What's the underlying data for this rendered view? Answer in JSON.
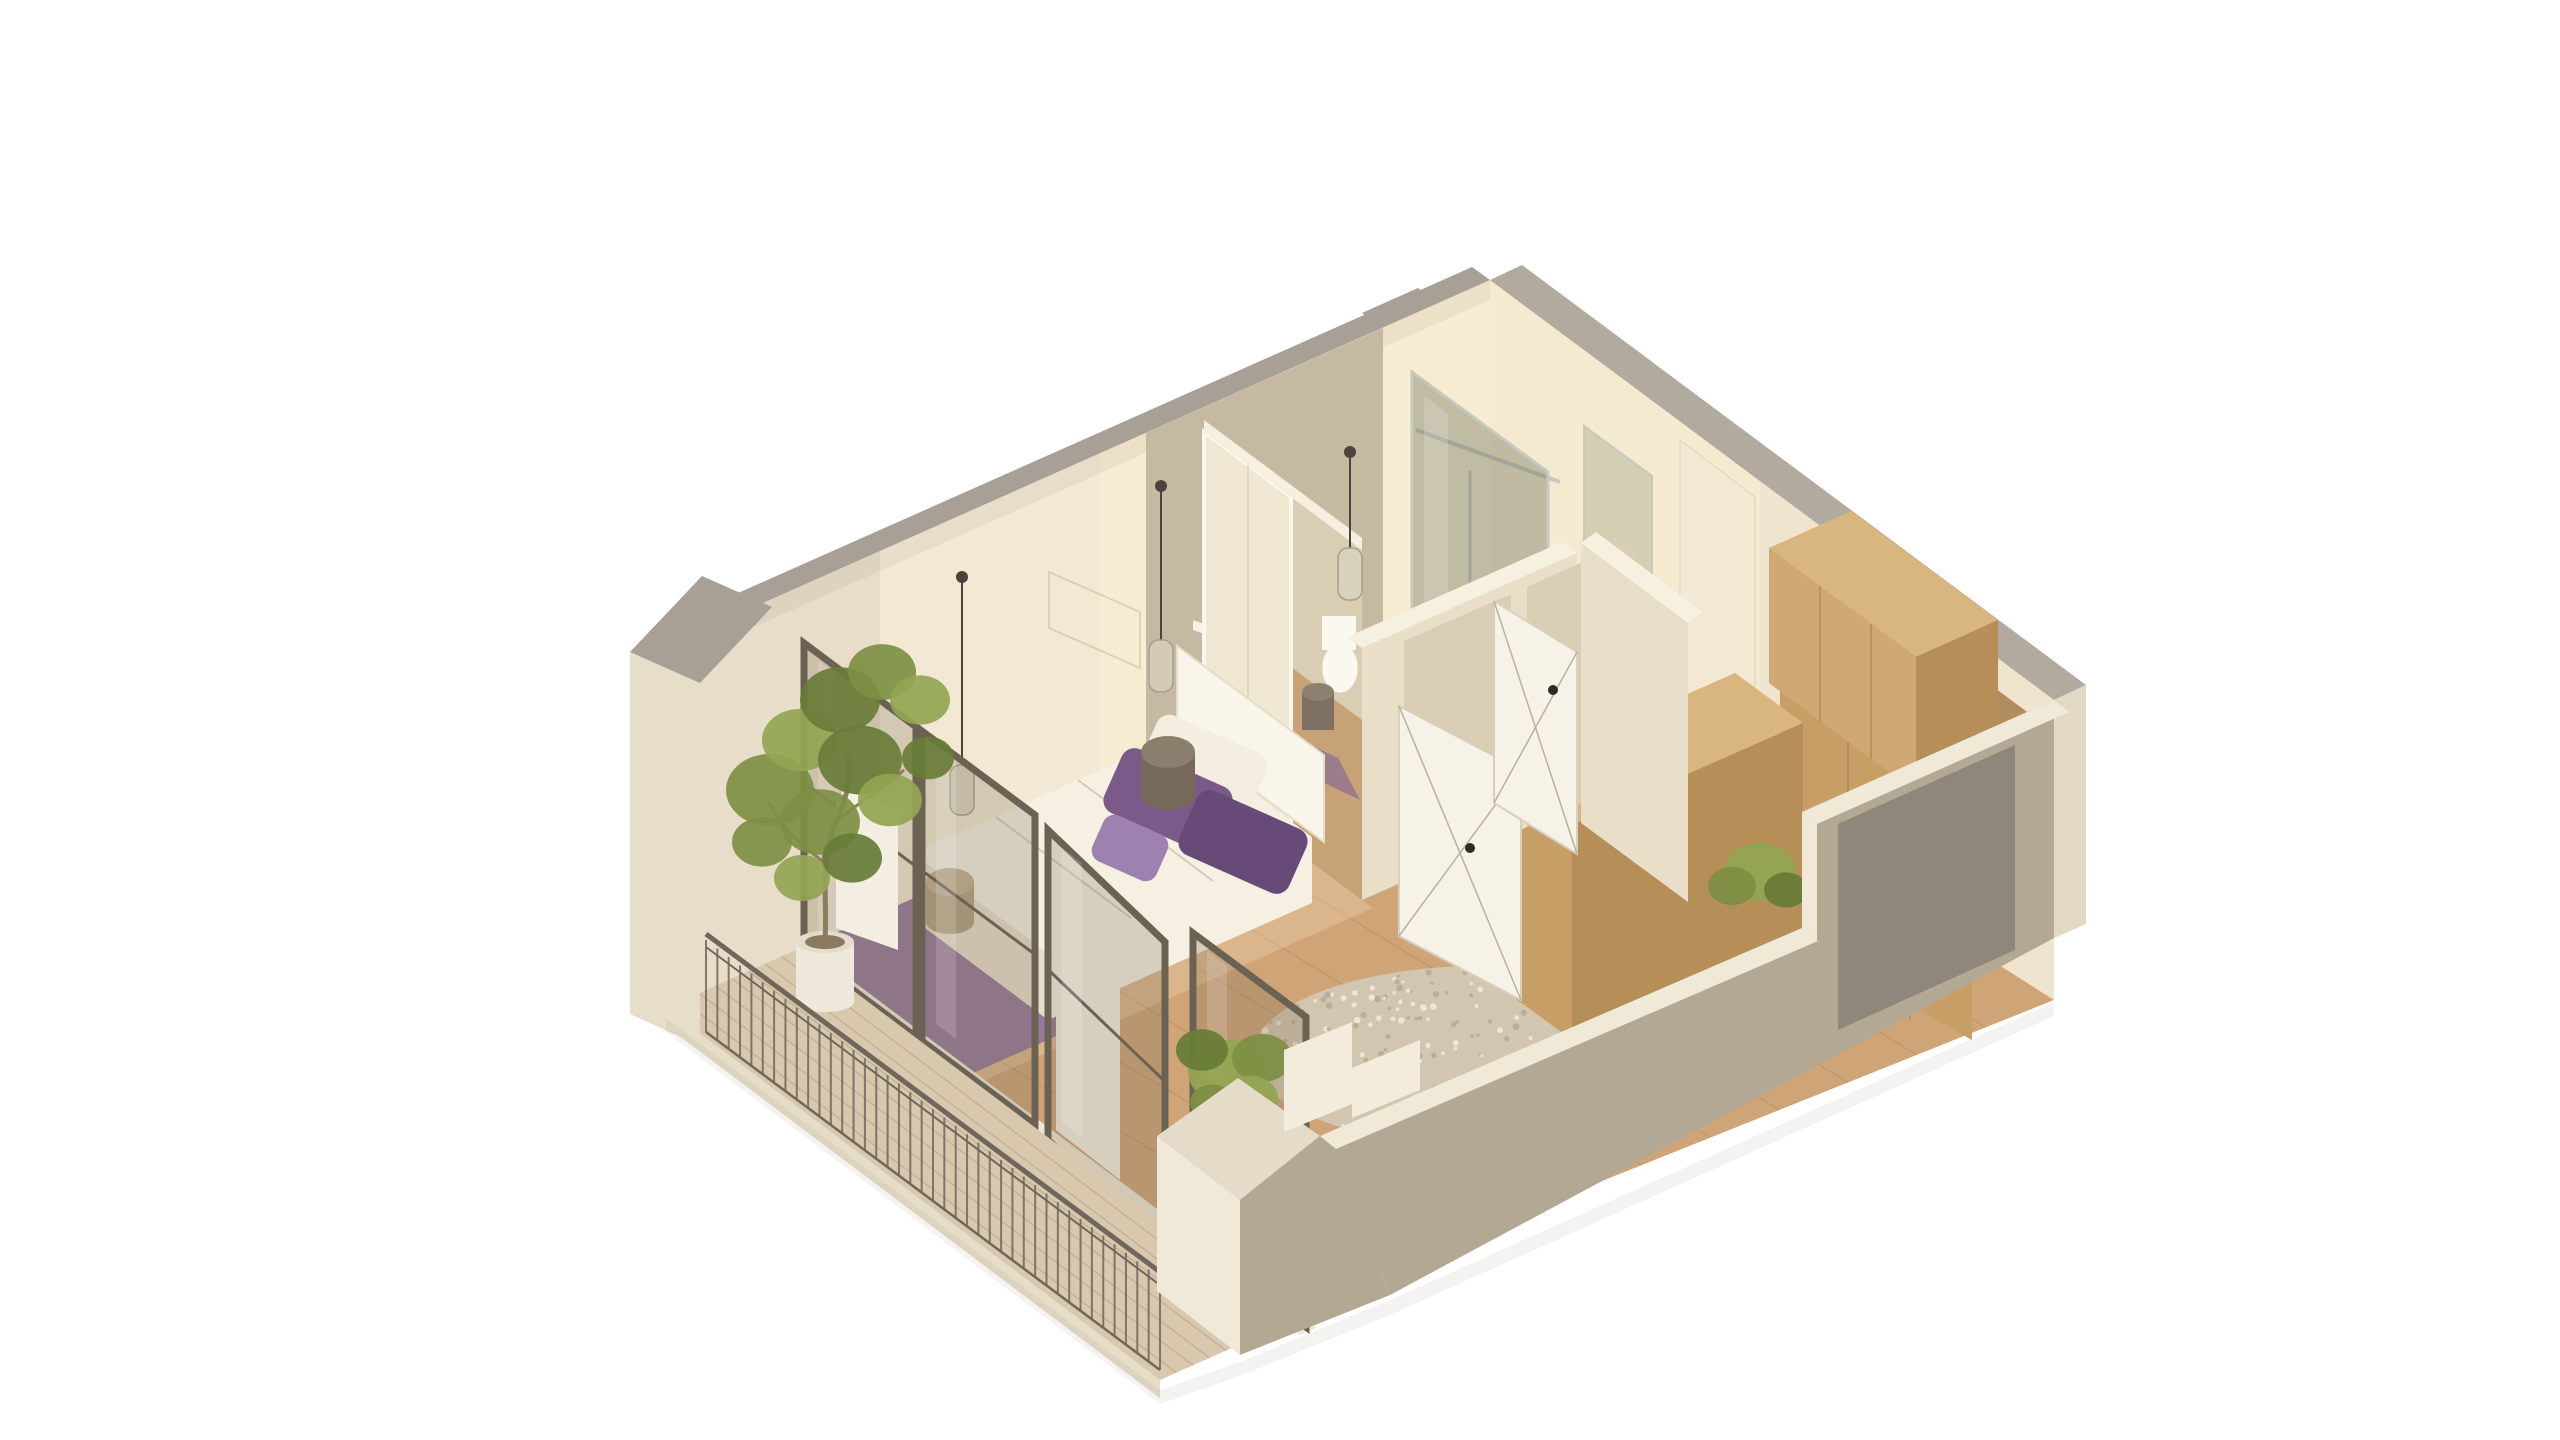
{
  "scene": {
    "type": "isometric-3d-apartment-floorplan-render",
    "background": "#ffffff",
    "rooms": [
      {
        "name": "bedroom"
      },
      {
        "name": "bathroom"
      },
      {
        "name": "living-hall"
      },
      {
        "name": "balcony"
      },
      {
        "name": "entry"
      }
    ],
    "objects": [
      "bed",
      "purple-pillows",
      "headboard",
      "wardrobe-sliding-doors",
      "walk-in-shower",
      "toilet",
      "interior-doors",
      "pendant-lamps",
      "glass-balcony-doors",
      "balcony-railing",
      "potted-tree",
      "planter-shrubs",
      "round-shag-rug",
      "purple-rug",
      "wood-cabinets",
      "entry-door-recess",
      "wicker-pouf"
    ]
  },
  "palette": {
    "bg": "#ffffff",
    "wall_inner_left": "#f2e8d3",
    "wall_inner_right": "#efe4cd",
    "wall_glow": "rgba(255,243,210,0.40)",
    "wall_shade": "rgba(120,100,80,0.08)",
    "cap_gray": "#a8a096",
    "cap_gray_light": "#b3aa9f",
    "exterior_cream": "#e7dec9",
    "end_wall": "#e2d9c4",
    "tile_wall": "#c6b9a2",
    "floor_wood": "#cfa578",
    "floor_light_overlay": "rgba(255,235,200,0.25)",
    "plank_line": "#aa7d50",
    "deck_wood": "#d8c8ad",
    "deck_line": "#b5a185",
    "slab_edge": "#e6ddc8",
    "front_wall": "#b2a894",
    "front_wall_top": "#f0e9d8",
    "front_wall_step": "#f3ecdc",
    "recess_gray": "#8f877b",
    "partition": "#e9dfc8",
    "partition_top": "#f6f0e1",
    "cream_panel": "#f2e8d4",
    "door_white": "#f7f2e8",
    "door_line": "#b9b1a0",
    "door_handle": "#2e2a24",
    "opening_wall": "#d9cdb4",
    "opening_floor": "#c7a277",
    "wardrobe_panel": "#f0e7d2",
    "wardrobe_top": "#f6efdf",
    "wood_front": "#c79f66",
    "wood_top": "#b18c5f",
    "wood_side": "#b58e58",
    "wood_light": "#cfa873",
    "wood_top_light": "#d9b57f",
    "wood_seam": "rgba(90,60,30,0.25)",
    "bed_white": "#f6f0e3",
    "bed_side": "#e7dfcc",
    "headboard": "#faf5ea",
    "pillow_white": "#f4eee1",
    "pillow_purple": "#7b5988",
    "pillow_purple_dark": "#684a78",
    "pillow_lilac": "#9d81b0",
    "rug_purple": "#8a6f9c",
    "rug_round": "#d3c6b0",
    "rug_dot_light": "#efe8da",
    "rug_dot_dark": "#b9ab93",
    "pouf_body": "#77695a",
    "pouf_top": "#8a7e6d",
    "basket_body": "#b3a284",
    "basket_top": "#c2b295",
    "pot_white": "#eee8da",
    "pot_soil": "#8a7a5e",
    "trunk_brown": "#8d7c5d",
    "green_mid": "#7d8f44",
    "green_light": "#93a553",
    "green_dark": "#687c38",
    "railing_metal": "#6f675c",
    "sill_white": "#efe8d8",
    "pier_white": "#f6f1e5",
    "glass_fill": "rgba(125,108,86,0.26)",
    "glass_frame": "#6b6254",
    "glass_streak": "rgba(255,255,255,0.16)",
    "shower_glass": "rgba(110,115,92,0.40)",
    "shower_glass_light": "rgba(140,150,118,0.32)",
    "chrome": "#c6c9bf",
    "tray_white": "#f4f0e4",
    "toilet_white": "#fbf8f0",
    "bin_body": "#7c7162",
    "bin_top": "#8d8070",
    "mat_purple": "rgba(127,99,154,0.6)",
    "pendant_cord": "#4a443c",
    "pendant_glass": "rgba(215,210,190,0.75)",
    "pendant_glass_stroke": "#a79f8c",
    "box_white": "#f3eee1",
    "art_line": "rgba(150,130,100,0.25)",
    "shadow": "rgba(60,50,40,0.06)"
  },
  "floor_planks": {
    "count": 11,
    "edge_a": [
      1490,
      642,
      666,
      1008
    ],
    "edge_b": [
      2054,
      1000,
      1230,
      1330
    ]
  },
  "deck_planks": {
    "count": 7,
    "edge_a": [
      798,
      949,
      666,
      1008
    ],
    "edge_b": [
      1292,
      1321,
      1160,
      1380
    ]
  },
  "railing": {
    "x1": 706,
    "y1": 934,
    "x2": 1160,
    "y2": 1272,
    "balusters": 40,
    "bar_len": 92
  },
  "round_rug": {
    "cx": 1480,
    "cy": 1056,
    "rx": 228,
    "ry": 90,
    "speckles": 260
  },
  "tree": {
    "trunk": "M825,940 C828,898 818,858 838,818 C848,792 852,776 848,756",
    "branch1": "M838,820 C862,800 884,788 904,770",
    "branch2": "M832,868 C804,848 782,828 768,802",
    "blobs": [
      [
        770,
        790,
        44
      ],
      [
        800,
        740,
        38
      ],
      [
        840,
        700,
        40
      ],
      [
        882,
        672,
        34
      ],
      [
        920,
        700,
        30
      ],
      [
        860,
        760,
        42
      ],
      [
        820,
        822,
        40
      ],
      [
        890,
        800,
        32
      ],
      [
        928,
        758,
        26
      ],
      [
        762,
        842,
        30
      ],
      [
        802,
        878,
        28
      ],
      [
        852,
        858,
        30
      ]
    ]
  },
  "console_shrub": [
    [
      1760,
      872,
      36
    ],
    [
      1732,
      886,
      24
    ],
    [
      1786,
      890,
      22
    ]
  ],
  "planter_shrub": [
    [
      1228,
      1072,
      40
    ],
    [
      1262,
      1058,
      30
    ],
    [
      1202,
      1050,
      26
    ],
    [
      1250,
      1098,
      28
    ],
    [
      1212,
      1102,
      22
    ]
  ],
  "pendants": [
    {
      "x": 962,
      "top": 577,
      "len": 188,
      "shade_w": 24,
      "shade_h": 50
    },
    {
      "x": 1161,
      "top": 486,
      "len": 154,
      "shade_w": 24,
      "shade_h": 52
    },
    {
      "x": 1350,
      "top": 452,
      "len": 96,
      "shade_w": 24,
      "shade_h": 52
    }
  ],
  "glass_panels": [
    [
      804,
      643,
      916,
      727,
      916,
      1037,
      804,
      953
    ],
    [
      922,
      731,
      1035,
      815,
      1035,
      1125,
      922,
      1041
    ],
    [
      1048,
      830,
      1165,
      942,
      1165,
      1252,
      1048,
      1140
    ],
    [
      1193,
      933,
      1306,
      1017,
      1306,
      1327,
      1193,
      1243
    ]
  ]
}
